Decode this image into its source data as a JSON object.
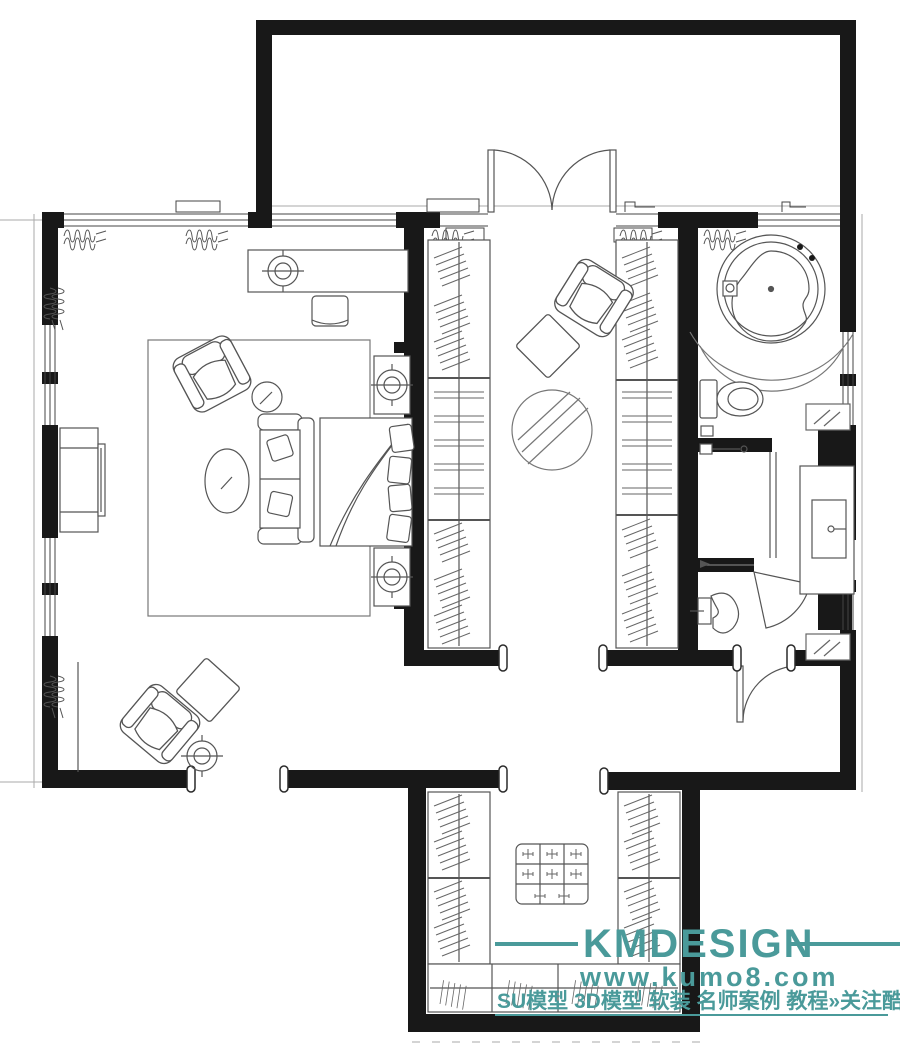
{
  "watermark": {
    "brand": "KMDESIGN",
    "website": "www.kumo8.com",
    "tagline": "SU模型 3D模型 软装 名师案例 教程»关注酷模吧",
    "color": "#4a9a9a"
  },
  "palette": {
    "wall": "#181818",
    "furniture_line": "#555555",
    "light_line": "#9a9a9a",
    "background": "#ffffff"
  },
  "plan": {
    "type": "residential-floor-plan",
    "rooms": [
      {
        "id": "upper-room",
        "name": "adjacent upper room",
        "furniture": []
      },
      {
        "id": "bedroom",
        "name": "master bedroom",
        "furniture": [
          "dressing-table",
          "ceiling-light",
          "desk-stool",
          "tv-cabinet",
          "tv",
          "area-rug",
          "armchair",
          "round-side-table",
          "oval-pouf",
          "loveseat-sofa",
          "double-bed",
          "nightstand",
          "nightstand",
          "lounge-chair",
          "ottoman",
          "floor-lamp"
        ]
      },
      {
        "id": "walk-in-closet",
        "name": "walk-in wardrobe corridor",
        "furniture": [
          "wardrobe-left",
          "wardrobe-right",
          "armchair",
          "ottoman",
          "round-rug",
          "double-entry-door"
        ]
      },
      {
        "id": "bathroom",
        "name": "master bathroom",
        "furniture": [
          "round-bathtub",
          "tub-platform",
          "toilet",
          "shower-enclosure",
          "bidet",
          "vanity-sink",
          "mirror-cabinet"
        ]
      },
      {
        "id": "lower-closet",
        "name": "lower walk-in closet",
        "furniture": [
          "wardrobe-left",
          "wardrobe-right",
          "wardrobe-bottom",
          "center-island"
        ]
      }
    ]
  }
}
